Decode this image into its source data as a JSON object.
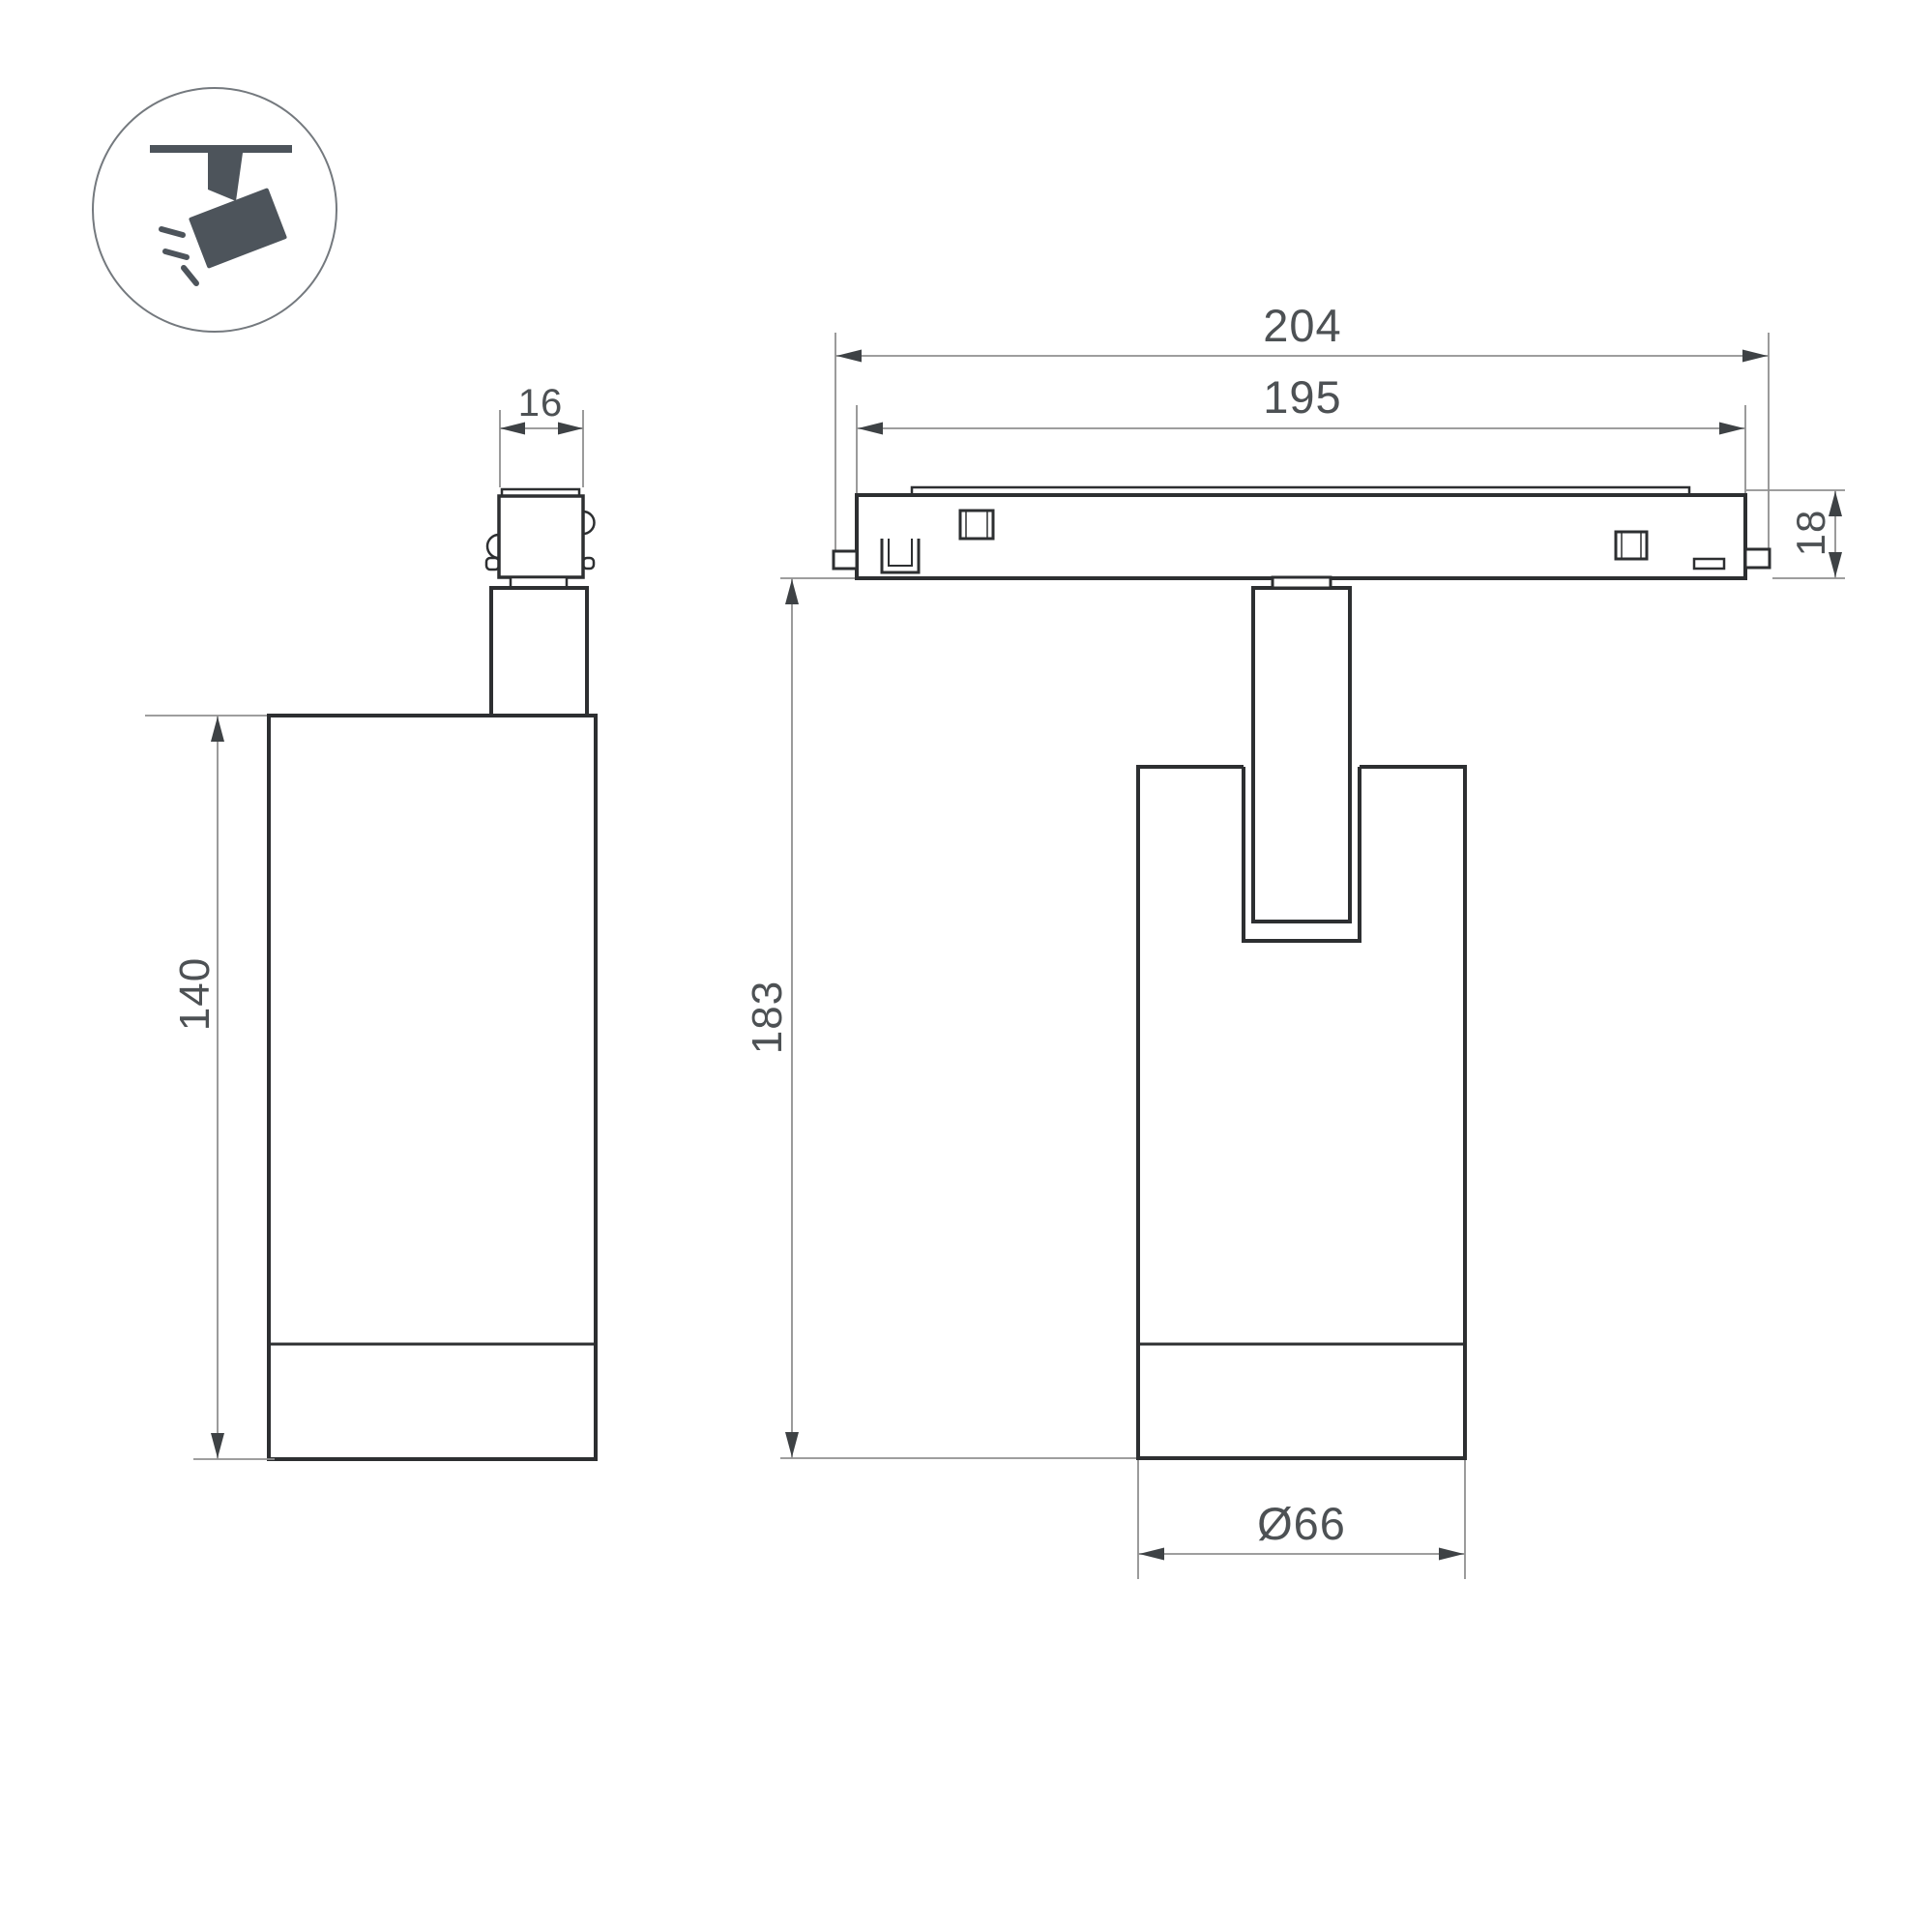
{
  "icon": {
    "name": "ceiling-track-spotlight-icon"
  },
  "colors": {
    "outline": "#2d2f31",
    "dimension_line": "#909090",
    "dimension_text": "#4d5154",
    "icon_fill": "#4d545b",
    "background": "#ffffff"
  },
  "dimensions": {
    "side_view": {
      "adapter_width": "16",
      "body_height": "140"
    },
    "front_view": {
      "overall_length": "204",
      "track_length": "195",
      "track_height": "18",
      "total_height": "183",
      "body_diameter": "Ø66"
    }
  }
}
